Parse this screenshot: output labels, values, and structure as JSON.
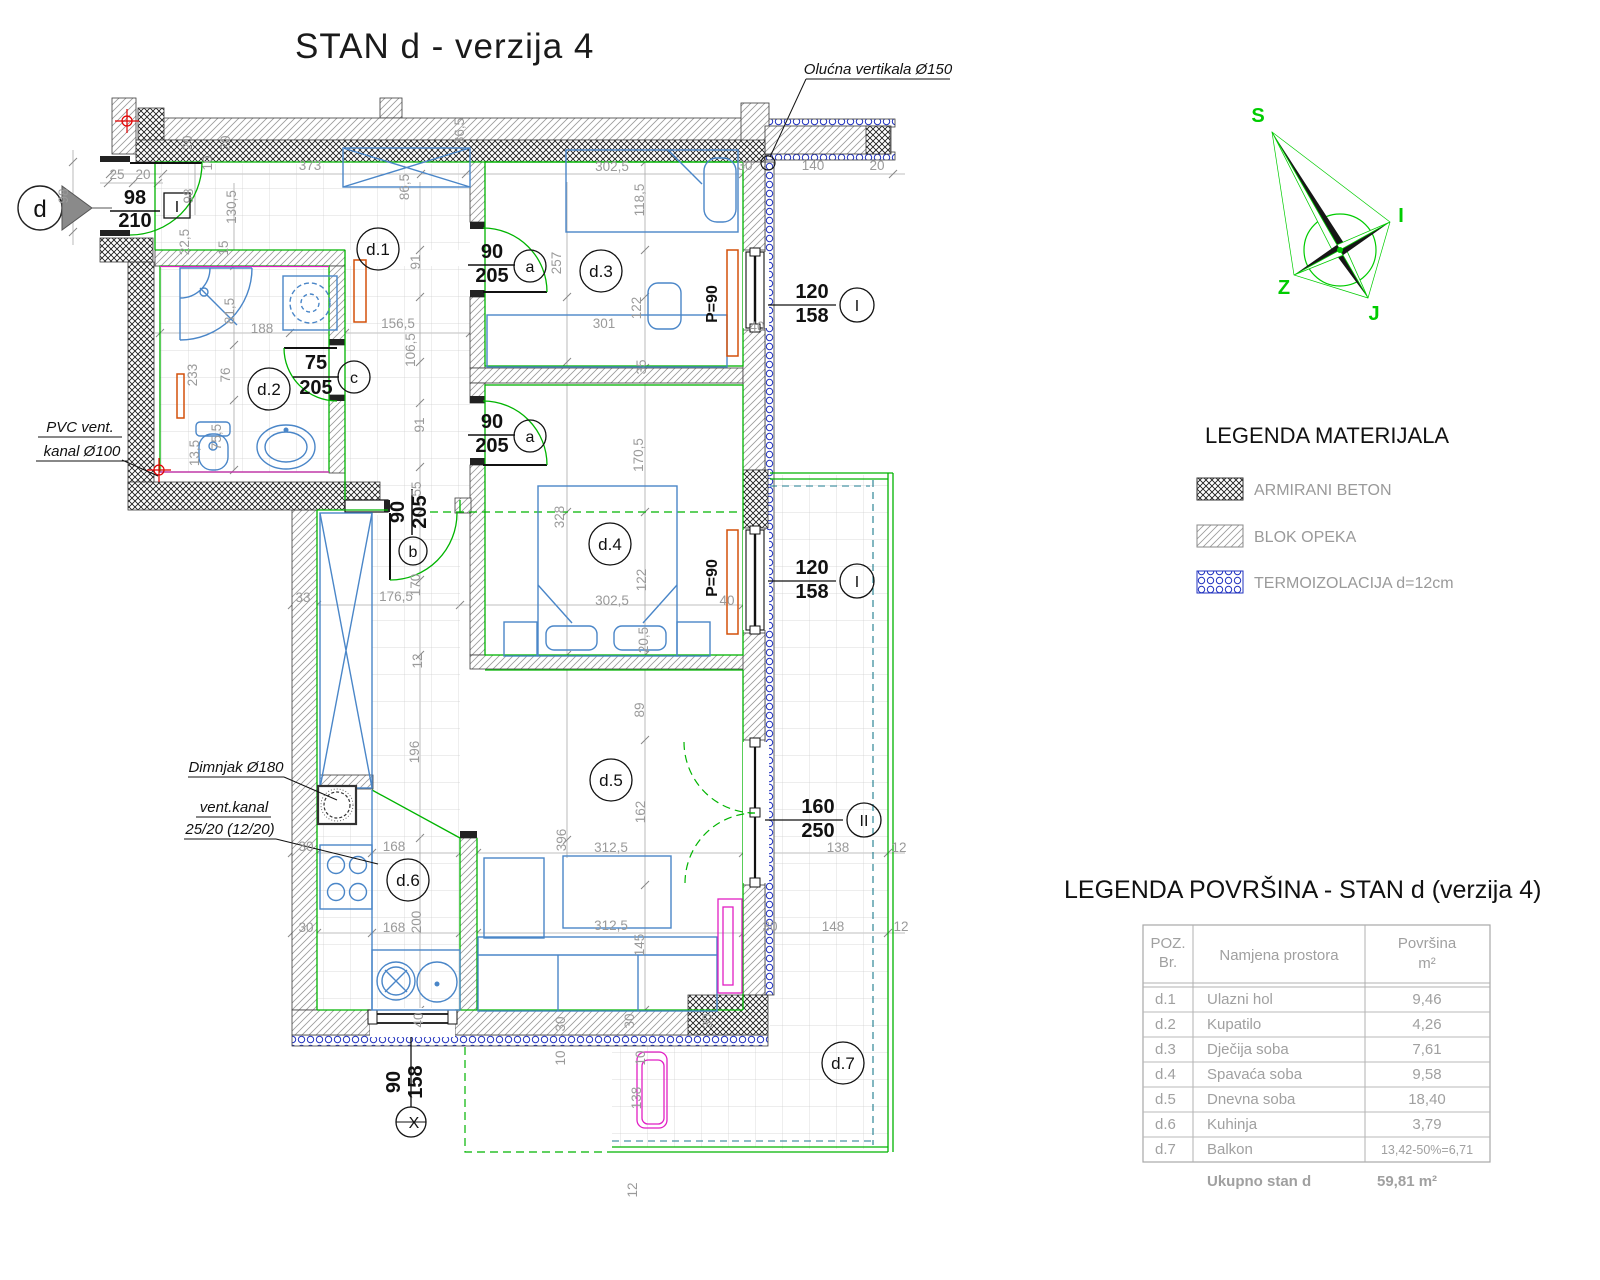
{
  "title": "STAN d - verzija 4",
  "compass": {
    "n": "S",
    "e": "I",
    "w": "Z",
    "s": "J"
  },
  "section_marker": "d",
  "notes": {
    "gutter": "Olućna vertikala Ø150",
    "pvc1": "PVC vent.",
    "pvc2": "kanal Ø100",
    "chimney": "Dimnjak Ø180",
    "vent1": "vent.kanal",
    "vent2": "25/20 (12/20)"
  },
  "openings": {
    "entry": {
      "w": "98",
      "h": "210",
      "tag": "I"
    },
    "a1": {
      "w": "90",
      "h": "205",
      "tag": "a"
    },
    "a2": {
      "w": "90",
      "h": "205",
      "tag": "a"
    },
    "b": {
      "w": "90",
      "h": "205",
      "tag": "b"
    },
    "c": {
      "w": "75",
      "h": "205",
      "tag": "c"
    },
    "win1": {
      "w": "120",
      "h": "158",
      "tag": "I"
    },
    "win2": {
      "w": "120",
      "h": "158",
      "tag": "I"
    },
    "bal": {
      "w": "160",
      "h": "250",
      "tag": "II"
    },
    "kwin": {
      "w": "90",
      "h": "158",
      "tag": "X"
    }
  },
  "radiator_label_1": "P=90",
  "radiator_label_2": "P=90",
  "legend_materials": {
    "title": "LEGENDA MATERIJALA",
    "items": [
      {
        "name": "armirani-beton",
        "label": "ARMIRANI BETON"
      },
      {
        "name": "blok-opeka",
        "label": "BLOK OPEKA"
      },
      {
        "name": "termoizolacija",
        "label": "TERMOIZOLACIJA d=12cm"
      }
    ]
  },
  "area_table": {
    "title": "LEGENDA POVRŠINA - STAN d (verzija 4)",
    "headers": {
      "poz1": "POZ.",
      "poz2": "Br.",
      "name": "Namjena prostora",
      "area1": "Površina",
      "area2": "m²"
    },
    "rows": [
      [
        "d.1",
        "Ulazni hol",
        "9,46"
      ],
      [
        "d.2",
        "Kupatilo",
        "4,26"
      ],
      [
        "d.3",
        "Dječija soba",
        "7,61"
      ],
      [
        "d.4",
        "Spavaća soba",
        "9,58"
      ],
      [
        "d.5",
        "Dnevna soba",
        "18,40"
      ],
      [
        "d.6",
        "Kuhinja",
        "3,79"
      ],
      [
        "d.7",
        "Balkon",
        "13,42-50%=6,71"
      ]
    ],
    "total_label": "Ukupno stan d",
    "total_value": "59,81 m²"
  },
  "plan": {
    "rooms": [
      {
        "id": "d.1",
        "x": 378,
        "y": 249
      },
      {
        "id": "d.2",
        "x": 269,
        "y": 389
      },
      {
        "id": "d.3",
        "x": 601,
        "y": 271
      },
      {
        "id": "d.4",
        "x": 610,
        "y": 544
      },
      {
        "id": "d.5",
        "x": 611,
        "y": 780
      },
      {
        "id": "d.6",
        "x": 408,
        "y": 880
      },
      {
        "id": "d.7",
        "x": 843,
        "y": 1063
      }
    ],
    "dims": [
      {
        "t": "25",
        "x": 117,
        "y": 179
      },
      {
        "t": "20",
        "x": 143,
        "y": 179
      },
      {
        "t": "373",
        "x": 310,
        "y": 170
      },
      {
        "t": "30",
        "x": 745,
        "y": 170
      },
      {
        "t": "140",
        "x": 813,
        "y": 170
      },
      {
        "t": "20",
        "x": 877,
        "y": 170
      },
      {
        "t": "98",
        "x": 68,
        "y": 196,
        "r": -90
      },
      {
        "t": "98",
        "x": 193,
        "y": 196,
        "r": -90
      },
      {
        "t": "130,5",
        "x": 236,
        "y": 207,
        "r": -90
      },
      {
        "t": "22,5",
        "x": 189,
        "y": 242,
        "r": -90
      },
      {
        "t": "15",
        "x": 228,
        "y": 248,
        "r": -90
      },
      {
        "t": "20",
        "x": 192,
        "y": 143,
        "r": -90
      },
      {
        "t": "10",
        "x": 212,
        "y": 163,
        "r": -90
      },
      {
        "t": "20",
        "x": 230,
        "y": 143,
        "r": -90
      },
      {
        "t": "36,5",
        "x": 464,
        "y": 131,
        "r": -90
      },
      {
        "t": "86,5",
        "x": 409,
        "y": 187,
        "r": -90
      },
      {
        "t": "91",
        "x": 420,
        "y": 262,
        "r": -90
      },
      {
        "t": "156,5",
        "x": 398,
        "y": 328
      },
      {
        "t": "106,5",
        "x": 415,
        "y": 350,
        "r": -90
      },
      {
        "t": "91",
        "x": 424,
        "y": 425,
        "r": -90
      },
      {
        "t": "55",
        "x": 421,
        "y": 489,
        "r": -90
      },
      {
        "t": "302,5",
        "x": 612,
        "y": 171
      },
      {
        "t": "118,5",
        "x": 644,
        "y": 200,
        "r": -90
      },
      {
        "t": "257",
        "x": 561,
        "y": 263,
        "r": -90
      },
      {
        "t": "122",
        "x": 641,
        "y": 308,
        "r": -90
      },
      {
        "t": "301",
        "x": 604,
        "y": 328
      },
      {
        "t": "35",
        "x": 646,
        "y": 367,
        "r": -90
      },
      {
        "t": "40",
        "x": 757,
        "y": 331
      },
      {
        "t": "170,5",
        "x": 643,
        "y": 455,
        "r": -90
      },
      {
        "t": "328",
        "x": 564,
        "y": 517,
        "r": -90
      },
      {
        "t": "122",
        "x": 646,
        "y": 580,
        "r": -90
      },
      {
        "t": "302,5",
        "x": 612,
        "y": 605
      },
      {
        "t": "40",
        "x": 727,
        "y": 605
      },
      {
        "t": "20,5",
        "x": 648,
        "y": 640,
        "r": -90
      },
      {
        "t": "33",
        "x": 303,
        "y": 602
      },
      {
        "t": "176,5",
        "x": 396,
        "y": 601
      },
      {
        "t": "170",
        "x": 420,
        "y": 585,
        "r": -90
      },
      {
        "t": "12",
        "x": 422,
        "y": 661,
        "r": -90
      },
      {
        "t": "196",
        "x": 419,
        "y": 752,
        "r": -90
      },
      {
        "t": "89",
        "x": 644,
        "y": 710,
        "r": -90
      },
      {
        "t": "162",
        "x": 645,
        "y": 812,
        "r": -90
      },
      {
        "t": "396",
        "x": 566,
        "y": 840,
        "r": -90
      },
      {
        "t": "312,5",
        "x": 611,
        "y": 852
      },
      {
        "t": "312,5",
        "x": 611,
        "y": 930
      },
      {
        "t": "145",
        "x": 644,
        "y": 945,
        "r": -90
      },
      {
        "t": "168",
        "x": 394,
        "y": 851
      },
      {
        "t": "168",
        "x": 394,
        "y": 932
      },
      {
        "t": "200",
        "x": 421,
        "y": 922,
        "r": -90
      },
      {
        "t": "30",
        "x": 306,
        "y": 851
      },
      {
        "t": "30",
        "x": 306,
        "y": 932
      },
      {
        "t": "30",
        "x": 770,
        "y": 931
      },
      {
        "t": "138",
        "x": 838,
        "y": 852
      },
      {
        "t": "12",
        "x": 899,
        "y": 852
      },
      {
        "t": "148",
        "x": 833,
        "y": 931
      },
      {
        "t": "12",
        "x": 901,
        "y": 931
      },
      {
        "t": "30",
        "x": 634,
        "y": 1021,
        "r": -90
      },
      {
        "t": "30",
        "x": 712,
        "y": 1021,
        "r": -90
      },
      {
        "t": "30",
        "x": 565,
        "y": 1024,
        "r": -90
      },
      {
        "t": "10",
        "x": 565,
        "y": 1058,
        "r": -90
      },
      {
        "t": "10",
        "x": 645,
        "y": 1058,
        "r": -90
      },
      {
        "t": "138",
        "x": 641,
        "y": 1098,
        "r": -90
      },
      {
        "t": "12",
        "x": 637,
        "y": 1190,
        "r": -90
      },
      {
        "t": "40",
        "x": 423,
        "y": 1020,
        "r": -90
      },
      {
        "t": "81,5",
        "x": 234,
        "y": 311,
        "r": -90
      },
      {
        "t": "188",
        "x": 262,
        "y": 333
      },
      {
        "t": "233",
        "x": 197,
        "y": 375,
        "r": -90
      },
      {
        "t": "76",
        "x": 230,
        "y": 375,
        "r": -90
      },
      {
        "t": "75,5",
        "x": 221,
        "y": 437,
        "r": -90
      },
      {
        "t": "13,5",
        "x": 199,
        "y": 453,
        "r": -90
      }
    ]
  }
}
